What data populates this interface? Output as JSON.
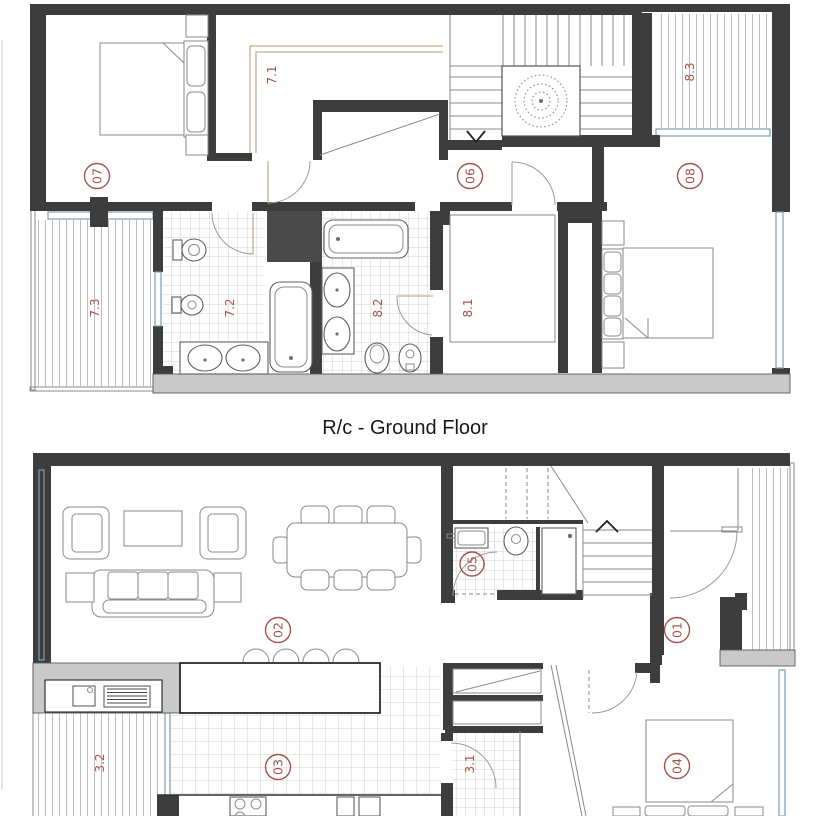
{
  "title": "R/c - Ground Floor",
  "colors": {
    "label_red": "#a5544c",
    "wall_dark": "#3d3d3d",
    "wall_fill_light": "#c9c9c9",
    "window_blue": "#7f9cb5",
    "wardrobe_tan": "#c2b091"
  },
  "first_floor": {
    "labels": {
      "bedroom_07": "07",
      "wardrobe_71": "7.1",
      "hall_06": "06",
      "bedroom_08": "08",
      "balcony_83": "8.3",
      "balcony_73": "7.3",
      "bathroom_72": "7.2",
      "bathroom_82": "8.2",
      "dressing_81": "8.1"
    }
  },
  "ground_floor": {
    "labels": {
      "living_02": "02",
      "hall_01": "01",
      "wc_05": "05",
      "kitchen_03": "03",
      "terrace_32": "3.2",
      "pantry_31": "3.1",
      "bedroom_04": "04"
    }
  }
}
